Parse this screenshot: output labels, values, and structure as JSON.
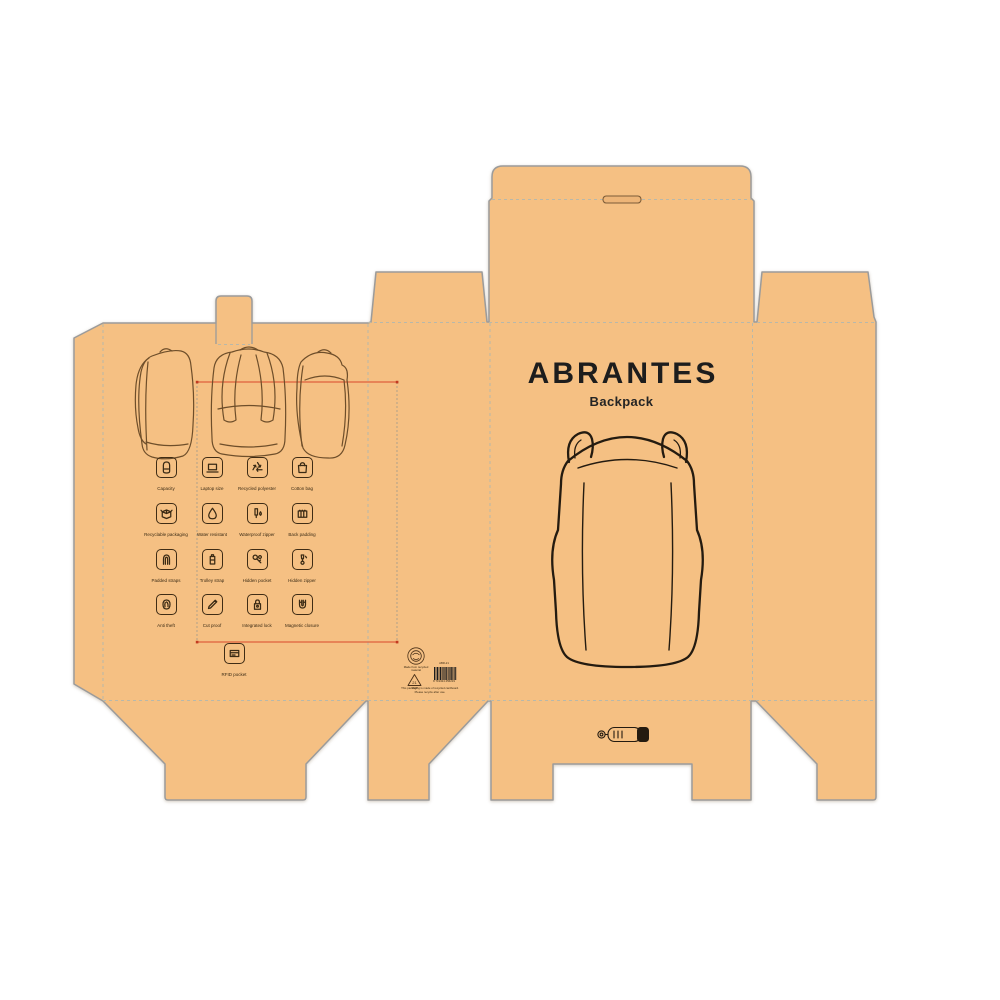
{
  "brand": {
    "title": "ABRANTES",
    "subtitle": "Backpack"
  },
  "features": [
    {
      "label": "Capacity",
      "icon": "backpack-icon"
    },
    {
      "label": "Laptop size",
      "icon": "laptop-icon"
    },
    {
      "label": "Recycled polyester",
      "icon": "recycle-icon"
    },
    {
      "label": "Cotton bag",
      "icon": "tote-bag-icon"
    },
    {
      "label": "Recyclable packaging",
      "icon": "box-icon"
    },
    {
      "label": "Water resistant",
      "icon": "droplet-icon"
    },
    {
      "label": "Waterproof zipper",
      "icon": "zipper-drop-icon"
    },
    {
      "label": "Back padding",
      "icon": "padding-icon"
    },
    {
      "label": "Padded straps",
      "icon": "strap-icon"
    },
    {
      "label": "Trolley strap",
      "icon": "trolley-icon"
    },
    {
      "label": "Hidden pocket",
      "icon": "keys-icon"
    },
    {
      "label": "Hidden zipper",
      "icon": "zipper-icon"
    },
    {
      "label": "Anti theft",
      "icon": "fingerprint-icon"
    },
    {
      "label": "Cut proof",
      "icon": "blade-icon"
    },
    {
      "label": "Integrated lock",
      "icon": "padlock-icon"
    },
    {
      "label": "Magnetic closure",
      "icon": "magnet-icon"
    },
    {
      "label": "RFID pocket",
      "icon": "card-icon"
    }
  ],
  "print_info": {
    "cert_line1": "Made from recycled",
    "cert_line2": "material",
    "recycle_code": "21",
    "recycle_code_sub": "PAP",
    "barcode_label": "ABR-21",
    "barcode_digits": "8 719324 456219",
    "fine_print_line1": "This packaging is made of recycled cardboard.",
    "fine_print_line2": "Please recycle after use."
  },
  "colors": {
    "board": "#f5c083",
    "cut_line": "#9b9b9b",
    "fold_line": "#b8b8aa",
    "ink": "#3a2a14",
    "illustration_ink": "#6e4e2a",
    "front_ink": "#241b10",
    "guide_red": "#d9472b",
    "title_ink": "#1d1d1d"
  }
}
